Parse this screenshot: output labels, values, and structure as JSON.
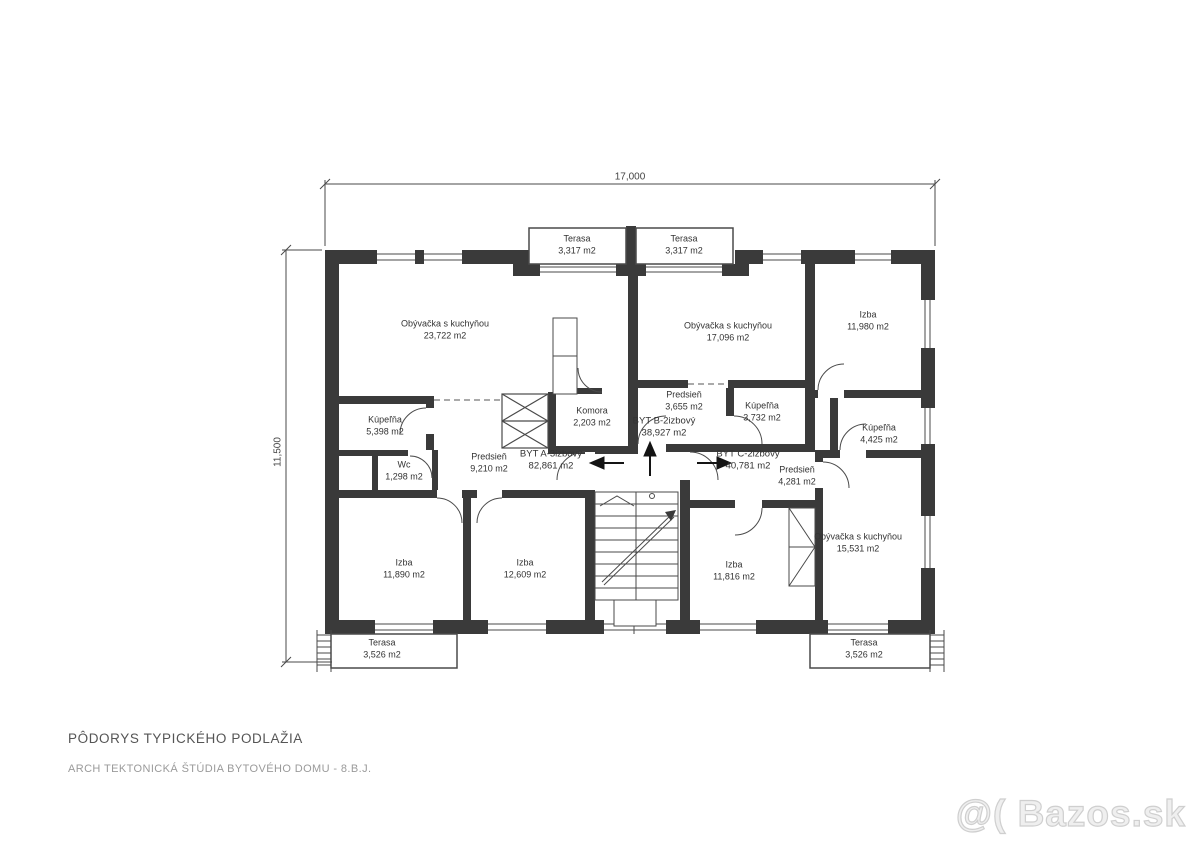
{
  "plan": {
    "dimensions": {
      "width": "17,000",
      "height": "11,500"
    },
    "apartments": {
      "byt_a": {
        "name": "BYT A-3izbový",
        "area": "82,861 m2",
        "entry_arrow": "left"
      },
      "byt_b": {
        "name": "BYT B-2izbový",
        "area": "38,927 m2",
        "entry_arrow": "up"
      },
      "byt_c": {
        "name": "BYT C-2izbový",
        "area": "40,781 m2",
        "entry_arrow": "right"
      }
    },
    "rooms": {
      "terasa_top_left": {
        "name": "Terasa",
        "area": "3,317 m2"
      },
      "terasa_top_right": {
        "name": "Terasa",
        "area": "3,317 m2"
      },
      "living_a": {
        "name": "Obývačka s kuchyňou",
        "area": "23,722 m2"
      },
      "living_b": {
        "name": "Obývačka s kuchyňou",
        "area": "17,096 m2"
      },
      "izba_top_right": {
        "name": "Izba",
        "area": "11,980 m2"
      },
      "kupelna_a": {
        "name": "Kúpeľňa",
        "area": "5,398 m2"
      },
      "wc_a": {
        "name": "Wc",
        "area": "1,298 m2"
      },
      "predsien_a": {
        "name": "Predsieň",
        "area": "9,210 m2"
      },
      "komora": {
        "name": "Komora",
        "area": "2,203 m2"
      },
      "predsien_b": {
        "name": "Predsieň",
        "area": "3,655 m2"
      },
      "kupelna_b": {
        "name": "Kúpeľňa",
        "area": "3,732 m2"
      },
      "kupelna_c": {
        "name": "Kúpeľňa",
        "area": "4,425 m2"
      },
      "predsien_c": {
        "name": "Predsieň",
        "area": "4,281 m2"
      },
      "izba_bottom_left": {
        "name": "Izba",
        "area": "11,890 m2"
      },
      "izba_bottom_mid": {
        "name": "Izba",
        "area": "12,609 m2"
      },
      "izba_bottom_right": {
        "name": "Izba",
        "area": "11,816 m2"
      },
      "living_c": {
        "name": "Obývačka s kuchyňou",
        "area": "15,531 m2"
      },
      "terasa_bottom_left": {
        "name": "Terasa",
        "area": "3,526 m2"
      },
      "terasa_bottom_right": {
        "name": "Terasa",
        "area": "3,526 m2"
      }
    }
  },
  "footer": {
    "title": "PÔDORYS TYPICKÉHO PODLAŽIA",
    "subtitle": "ARCH TEKTONICKÁ ŠTÚDIA BYTOVÉHO DOMU - 8.B.J."
  },
  "watermark": {
    "text": "@( Bazos.sk"
  },
  "colors": {
    "wall": "#3a3a3a",
    "line": "#4a4a4a",
    "text": "#333333",
    "footer_title": "#555555",
    "footer_subtitle": "#9a9a9a",
    "watermark": "#cfcfcf"
  }
}
